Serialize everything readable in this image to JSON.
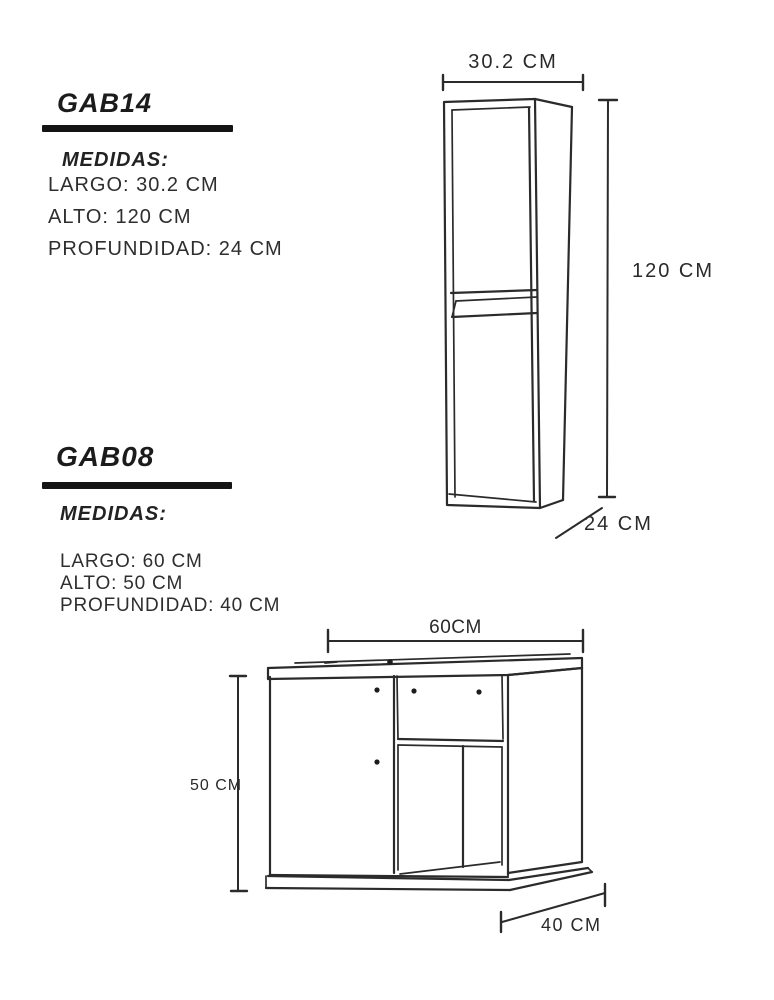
{
  "page": {
    "background_color": "#ffffff",
    "ink_color": "#262626",
    "line_color": "#2b2b2b"
  },
  "products": [
    {
      "code": "GAB14",
      "medidas_heading": "MEDIDAS:",
      "specs": [
        "LARGO: 30.2 CM",
        "ALTO: 120 CM",
        "PROFUNDIDAD: 24 CM"
      ],
      "dimension_labels": {
        "width": "30.2 CM",
        "height": "120 CM",
        "depth": "24 CM"
      }
    },
    {
      "code": "GAB08",
      "medidas_heading": "MEDIDAS:",
      "specs": [
        "LARGO: 60 CM",
        "ALTO: 50 CM",
        "PROFUNDIDAD: 40 CM"
      ],
      "dimension_labels": {
        "width": "60CM",
        "height": "50 CM",
        "depth": "40 CM"
      }
    }
  ]
}
